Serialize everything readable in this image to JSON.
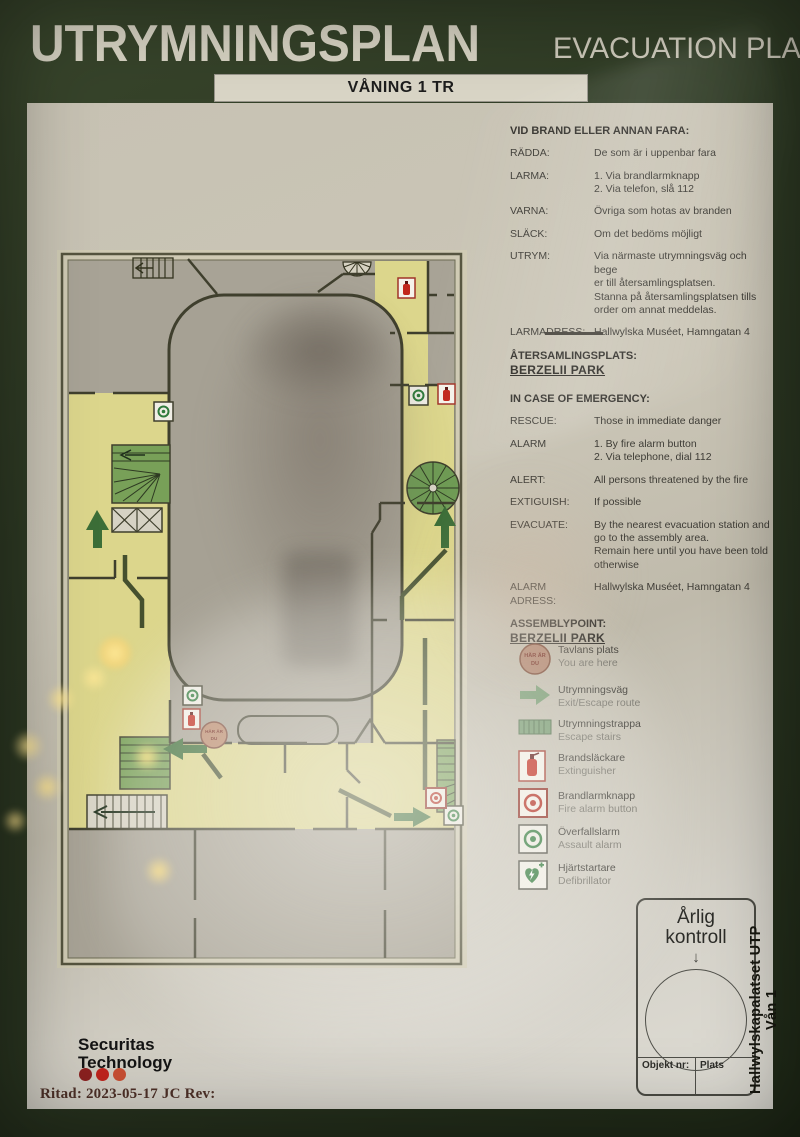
{
  "header": {
    "title_sv": "UTRYMNINGSPLAN",
    "title_en": "EVACUATION PLAN",
    "floor_label": "VÅNING 1 TR"
  },
  "instructions_sv": {
    "heading": "VID BRAND ELLER ANNAN FARA:",
    "rows": [
      {
        "label": "RÄDDA:",
        "text": "De som är i uppenbar fara"
      },
      {
        "label": "LARMA:",
        "text": "1. Via brandlarmknapp\n2. Via telefon, slå 112"
      },
      {
        "label": "VARNA:",
        "text": "Övriga som hotas av branden"
      },
      {
        "label": "SLÄCK:",
        "text": "Om det bedöms möjligt"
      },
      {
        "label": "UTRYM:",
        "text": "Via närmaste utrymningsväg och bege\ner till återsamlingsplatsen.\nStanna på återsamlingsplatsen tills\norder om annat meddelas."
      },
      {
        "label": "LARMADRESS:",
        "text": "Hallwylska Muséet, Hamngatan 4"
      }
    ],
    "assembly_heading": "ÅTERSAMLINGSPLATS:",
    "assembly_value": "BERZELII PARK"
  },
  "instructions_en": {
    "heading": "IN CASE OF EMERGENCY:",
    "rows": [
      {
        "label": "RESCUE:",
        "text": "Those in immediate danger"
      },
      {
        "label": "ALARM",
        "text": "1. By fire alarm button\n2. Via telephone, dial 112"
      },
      {
        "label": "ALERT:",
        "text": "All persons threatened by the fire"
      },
      {
        "label": "EXTIGUISH:",
        "text": "If possible"
      },
      {
        "label": "EVACUATE:",
        "text": "By the nearest evacuation station and\ngo to the assembly area.\nRemain here until you have been told\notherwise"
      },
      {
        "label": "ALARM ADRESS:",
        "text": "Hallwylska Muséet, Hamngatan 4"
      }
    ],
    "assembly_heading": "ASSEMBLYPOINT:",
    "assembly_value": "BERZELII PARK"
  },
  "legend": {
    "items": [
      {
        "icon": "you-are-here",
        "sv": "Tavlans plats",
        "en": "You are here"
      },
      {
        "icon": "escape-route-arrow",
        "sv": "Utrymningsväg",
        "en": "Exit/Escape route"
      },
      {
        "icon": "escape-stairs",
        "sv": "Utrymningstrappa",
        "en": "Escape stairs"
      },
      {
        "icon": "extinguisher",
        "sv": "Brandsläckare",
        "en": "Extinguisher"
      },
      {
        "icon": "fire-alarm-button",
        "sv": "Brandlarmknapp",
        "en": "Fire alarm button"
      },
      {
        "icon": "assault-alarm",
        "sv": "Överfallslarm",
        "en": "Assault alarm"
      },
      {
        "icon": "defibrillator",
        "sv": "Hjärtstartare",
        "en": "Defibrillator"
      }
    ]
  },
  "plan_marker": {
    "line1": "HÄR ÄR",
    "line2": "DU"
  },
  "inspection_box": {
    "title_line1": "Årlig",
    "title_line2": "kontroll",
    "arrow": "↓",
    "object_label": "Objekt nr:",
    "place_label": "Plats"
  },
  "side_label": "Hallwylskapalatset UTP Vån 1",
  "footer": {
    "brand_line1": "Securitas",
    "brand_line2": "Technology",
    "drawn": "Ritad: 2023-05-17 JC  Rev:"
  },
  "colors": {
    "frame_green": "#2e3a24",
    "panel_cream": "#cbc6b7",
    "corridor_yellow": "#dcd68c",
    "room_grey": "#a8a396",
    "wall_olive": "#3f3f2d",
    "escape_green": "#45502e",
    "stairs_green": "#78a058",
    "arrow_green": "#3c6e38",
    "alarm_red": "#b3281c",
    "assault_green": "#2f7a3c",
    "marker_tan": "#b98668",
    "dot1": "#8c2120",
    "dot2": "#c0241d",
    "dot3": "#c94f33"
  }
}
